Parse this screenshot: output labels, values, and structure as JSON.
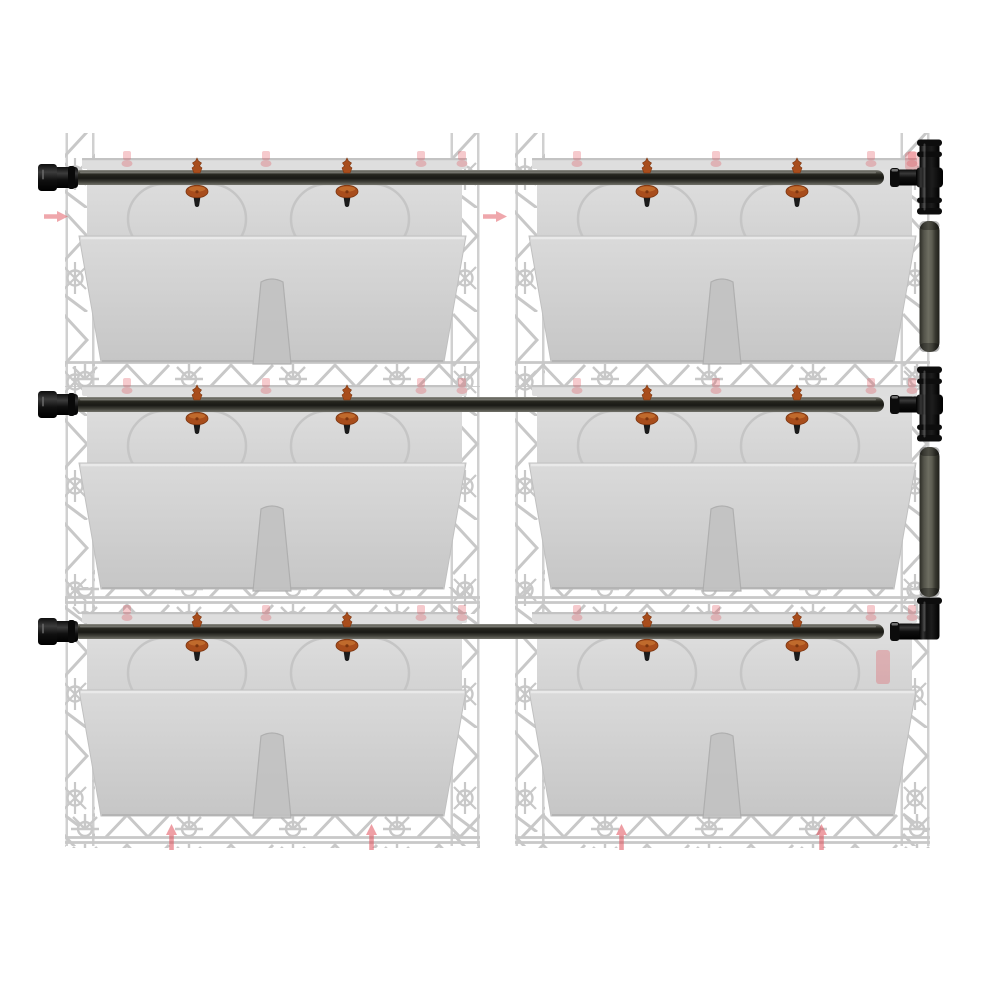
{
  "scene": {
    "kind": "product-photo",
    "subject": "vertical-garden-wall-planter-irrigation-kit",
    "background": "#ffffff"
  },
  "components": {
    "trellis_columns": 2,
    "planter_boxes": 6,
    "supply_tubes": 3,
    "tube_end_caps": 3,
    "drip_emitters": 12,
    "tee_connectors": 2,
    "elbow_connectors": 1,
    "riser_tube_segments": 2
  },
  "palette": {
    "background": "#ffffff",
    "tube_light": "#90908a",
    "tube_mid": "#3f3f38",
    "tube_dark": "#1b1b16",
    "riser_light": "#6d6d61",
    "riser_dark": "#2c2c26",
    "fitting_black": "#0d0d0d",
    "fitting_highlight": "#6a6a6a",
    "emitter_orange": "#a84d1c",
    "emitter_orange_light": "#c4702f",
    "emitter_orange_dark": "#7c350f",
    "emitter_barb": "#1b1b1b",
    "planter_rim": "#dedede",
    "planter_interior_top": "#e0e0e0",
    "planter_interior_bottom": "#d2d2d2",
    "planter_wall_top": "#dadada",
    "planter_wall_bottom": "#c6c6c6",
    "planter_line": "#bcbcbc",
    "wall_highlight": "#ebebeb",
    "spout": "#c2c2c2",
    "trellis_gray": "#b0b0b0",
    "ghost_red": "#e04f5a"
  },
  "geometry": {
    "canvas": {
      "w": 1000,
      "h": 1000
    },
    "columns": [
      {
        "x": 65
      },
      {
        "x": 515
      }
    ],
    "column_width": 415,
    "rows": [
      {
        "rim_y": 158
      },
      {
        "rim_y": 385
      },
      {
        "rim_y": 612
      }
    ],
    "planter": {
      "rim_inset": 17,
      "rim_w": 385,
      "rim_h": 11,
      "interior_h": 78,
      "wall_h": 126,
      "wall_top_inset_l": 14,
      "wall_top_inset_r": 14,
      "wall_taper": 22,
      "arc_offsets": [
        63,
        226
      ],
      "arc_w": 118,
      "arc_h": 70,
      "spout_cx_offset": 207,
      "spout_top_w": 22,
      "spout_bottom_w": 38,
      "spout_top_drop": 46
    },
    "trellis": {
      "top_y": 133,
      "bottom_y": 846,
      "strip_w": 30,
      "band_h": 30
    },
    "tube": {
      "x1": 72,
      "x2": 884,
      "h": 15,
      "top_offset": 12
    },
    "end_cap": {
      "x": 38
    },
    "emitter_offsets": [
      132,
      282
    ],
    "riser": {
      "x": 919.5,
      "w": 20,
      "segments": [
        [
          221,
          352
        ],
        [
          447,
          597
        ]
      ]
    },
    "fittings": [
      {
        "row": 0,
        "type": "tee"
      },
      {
        "row": 1,
        "type": "tee"
      },
      {
        "row": 2,
        "type": "elbow"
      }
    ]
  },
  "red_marks": {
    "arrows_right": [
      [
        44,
        211
      ],
      [
        483,
        211
      ]
    ],
    "arrows_up": [
      [
        166,
        824
      ],
      [
        366,
        824
      ],
      [
        616,
        824
      ],
      [
        816,
        824
      ]
    ],
    "rim_clip_offsets": [
      58,
      197,
      352,
      393
    ],
    "extra_clips": [
      [
        905,
        152,
        14,
        18
      ],
      [
        876,
        650,
        14,
        34
      ]
    ]
  }
}
